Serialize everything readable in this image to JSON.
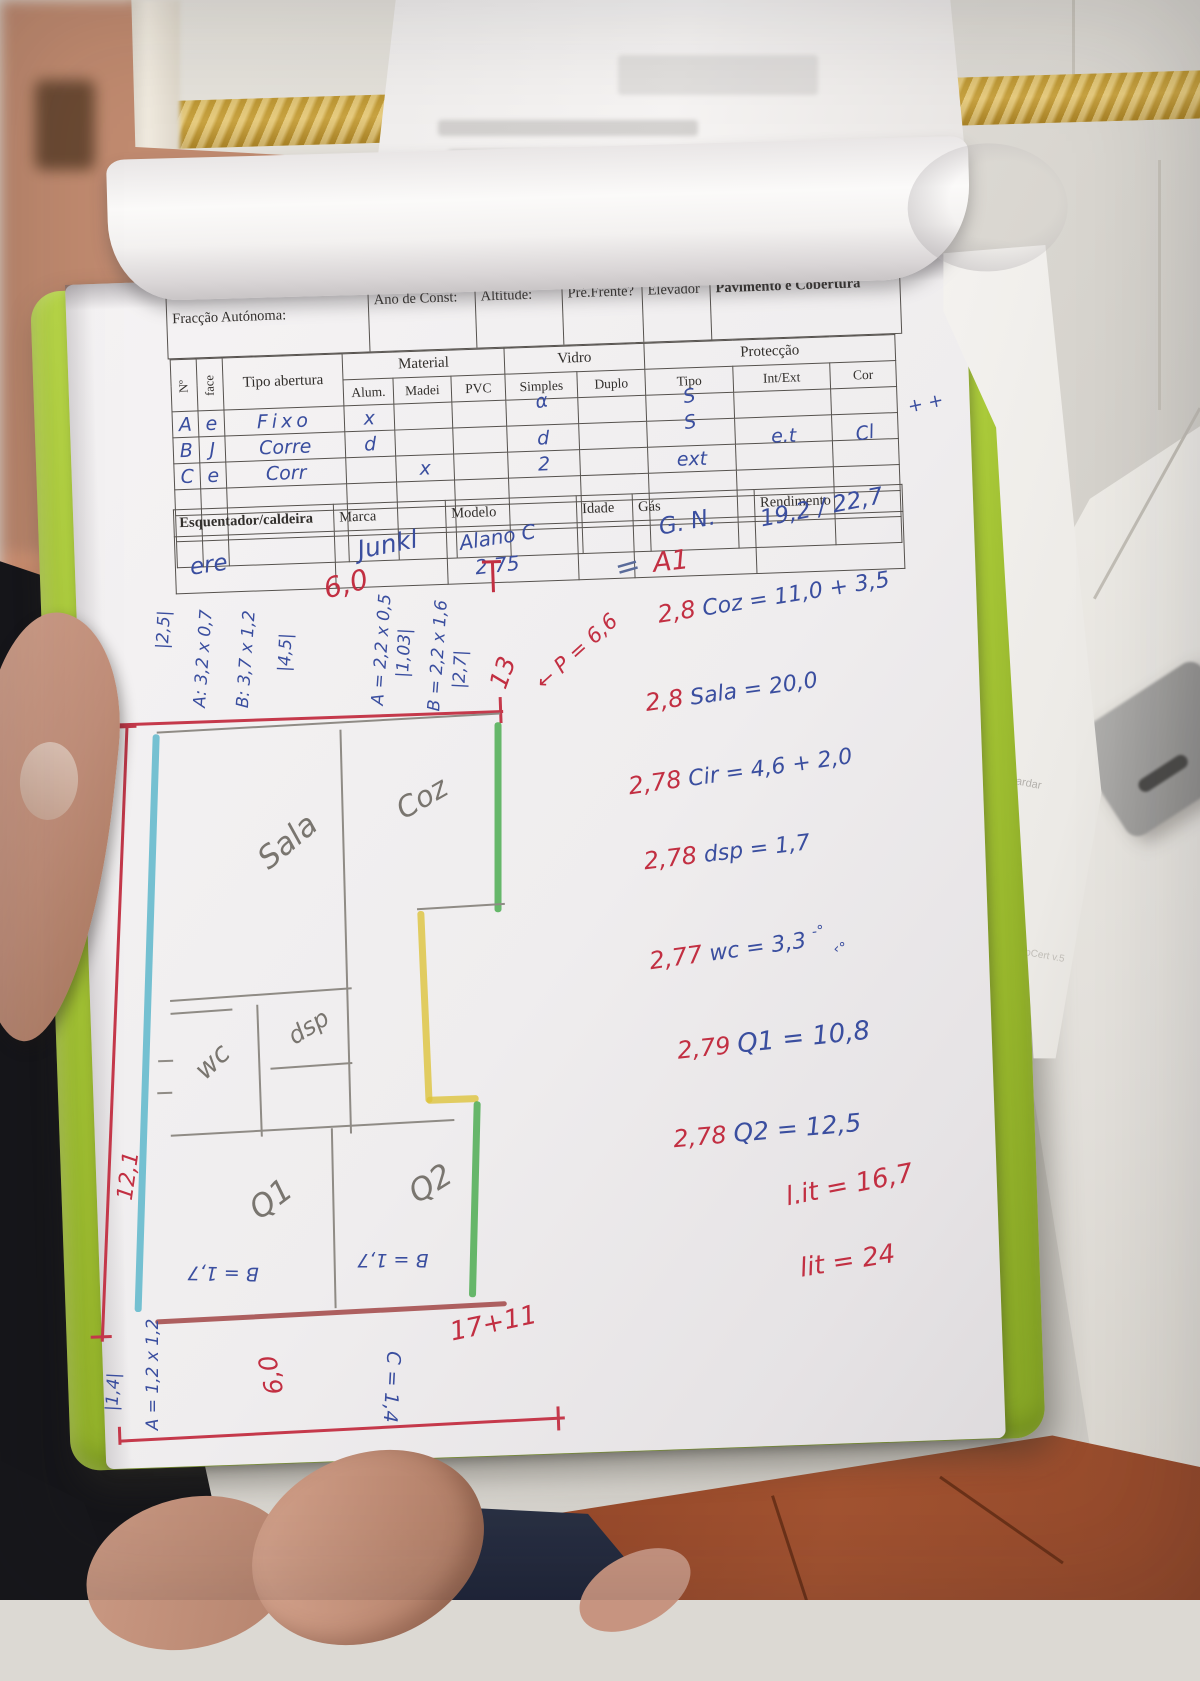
{
  "form": {
    "owner_handwritten": "Bacah Olesup",
    "header": {
      "fraccao": "Fracção Autónoma:",
      "ano": "Ano de Const:",
      "altitude": "Altitude:",
      "pre_frente": "Pré.Frente?",
      "elevador": "Elevador",
      "pavimento": "Pavimento e Cobertura"
    },
    "openings": {
      "group": {
        "material": "Material",
        "vidro": "Vidro",
        "proteccao": "Protecção"
      },
      "cols": {
        "num": "Nº",
        "face": "face",
        "tipo_abertura": "Tipo abertura",
        "alum": "Alum.",
        "madei": "Madei",
        "pvc": "PVC",
        "simples": "Simples",
        "duplo": "Duplo",
        "tipo": "Tipo",
        "int_ext": "Int/Ext",
        "cor": "Cor"
      },
      "rows": [
        {
          "num": "A",
          "face": "e",
          "tipo_abertura": "Fixo",
          "alum": "x",
          "simples": "α",
          "tipo": "S"
        },
        {
          "num": "B",
          "face": "J",
          "tipo_abertura": "Corre",
          "alum": "d",
          "simples": "d",
          "tipo": "S",
          "int_ext": "e.t",
          "cor": "Cl"
        },
        {
          "num": "C",
          "face": "e",
          "tipo_abertura": "Corr",
          "madei": "x",
          "simples": "2",
          "tipo": "ext"
        }
      ],
      "margin_note": "+ +"
    },
    "heater": {
      "cols": {
        "esq": "Esquentador/caldeira",
        "marca": "Marca",
        "modelo": "Modelo",
        "idade": "Idade",
        "gas": "Gás",
        "rend": "Rendimento"
      },
      "values": {
        "esq": "ere",
        "marca": "Junkl",
        "modelo": "Alano C",
        "modelo_num": "2 75",
        "gas": "G. N.",
        "rend": "19,2 / 22,7"
      }
    }
  },
  "calcs": {
    "a1_eq": "=",
    "a1": "A1",
    "lines": [
      {
        "coef": "2,8",
        "expr": "Coz = 11,0 + 3,5"
      },
      {
        "coef": "2,8",
        "expr": "Sala = 20,0"
      },
      {
        "coef": "2,78",
        "expr": "Cir = 4,6 + 2,0"
      },
      {
        "coef": "2,78",
        "expr": "dsp = 1,7"
      },
      {
        "coef": "2,77",
        "expr": "wc = 3,3",
        "mark1": "-°",
        "mark2": "‹°"
      },
      {
        "coef": "2,79",
        "expr": "Q1 = 10,8"
      },
      {
        "coef": "2,78",
        "expr": "Q2 = 12,5"
      }
    ],
    "lit1": "l.it = 16,7",
    "lit2": "lit = 24"
  },
  "plan": {
    "labels": {
      "sala": "Sala",
      "coz": "Coz",
      "wc": "wc",
      "dsp": "dsp",
      "q1": "Q1",
      "q2": "Q2"
    },
    "top_measures": [
      "|2,5|",
      "A: 3,2 x 0,7",
      "B: 3,7 x 1,2",
      "|4,5|",
      "6,0",
      "A = 2,2 x 0,5",
      "|1,03|",
      "B = 2,2 x 1,6",
      "|2,7|",
      "13",
      "P = 6,6"
    ],
    "arrow": "←",
    "left_measure": "12,1",
    "bottom": {
      "b1": "B = 1,7",
      "b2": "B = 1,7",
      "c": "C = 1,4",
      "sum": "17+11",
      "six": "6,0",
      "a": "A = 1,2 x 1,2",
      "tick": "|1,4|"
    }
  },
  "background": {
    "note1": "ambos guardar",
    "note2": "MobileDadPropCert v.5",
    "marks": "5o"
  }
}
